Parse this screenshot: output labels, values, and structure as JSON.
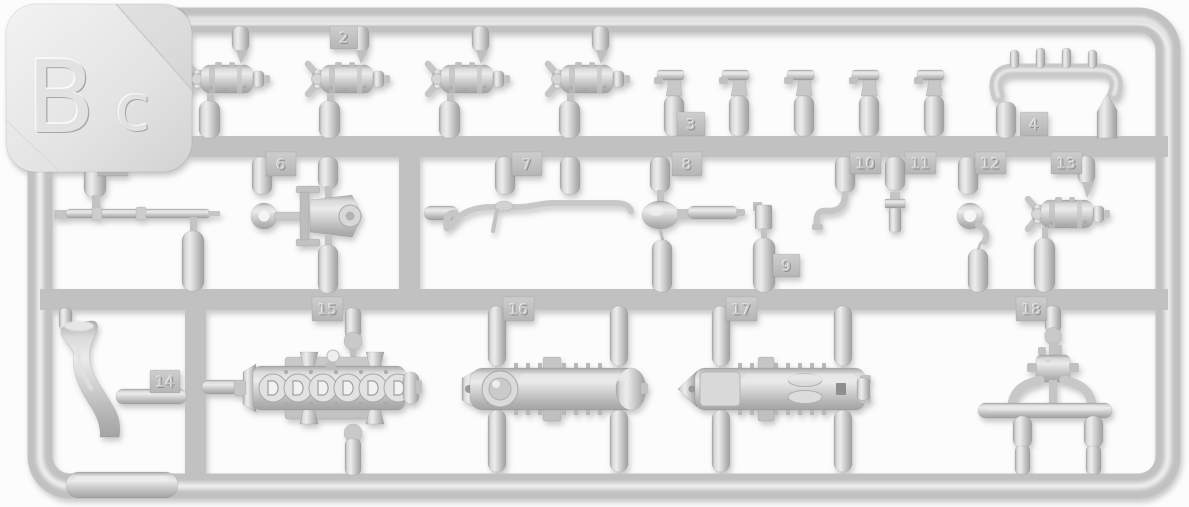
{
  "photo": {
    "subject": "Injection-molded styrene model kit sprue (runner frame) with numbered parts",
    "sprue_code": "Bc",
    "sprue_code_main": "B",
    "sprue_code_sub": "c",
    "plastic_color": "#c6c6c6",
    "highlight_color": "#e6e6e6",
    "shadow_color": "#9d9d9d",
    "background_color": "#fcfcfc",
    "part_count": 18
  },
  "parts": [
    {
      "label": "1",
      "shape": "horizontal cylinder with forked clevis front (first of five identical)"
    },
    {
      "label": "2",
      "shape": "horizontal cylinder with forked clevis front (same group of five)"
    },
    {
      "label": "3",
      "shape": "five small flat-capped nozzle fittings on upright gates"
    },
    {
      "label": "4",
      "shape": "curved manifold pipe with four upright stubs"
    },
    {
      "label": "5",
      "shape": "long thin linkage rod with two collars"
    },
    {
      "label": "6",
      "shape": "bracket mount with eye ring and roller"
    },
    {
      "label": "7",
      "shape": "bent grab-handle rod"
    },
    {
      "label": "8",
      "shape": "egg-shaped bulb with stem pipe"
    },
    {
      "label": "9",
      "shape": "small rectangular valve fitting"
    },
    {
      "label": "10",
      "shape": "curved hook"
    },
    {
      "label": "11",
      "shape": "bolt with hex collar"
    },
    {
      "label": "12",
      "shape": "towing ring with chain link"
    },
    {
      "label": "13",
      "shape": "horizontal cylinder with forked clevis front"
    },
    {
      "label": "14",
      "shape": "curved chute / deflector"
    },
    {
      "label": "15",
      "shape": "engine crankcase half with six round D-ports"
    },
    {
      "label": "16",
      "shape": "engine cover with round end cap and ribbed edges"
    },
    {
      "label": "17",
      "shape": "engine cover half with twin bosses"
    },
    {
      "label": "18",
      "shape": "distributor body with twin curved pipes and cross tube"
    }
  ]
}
